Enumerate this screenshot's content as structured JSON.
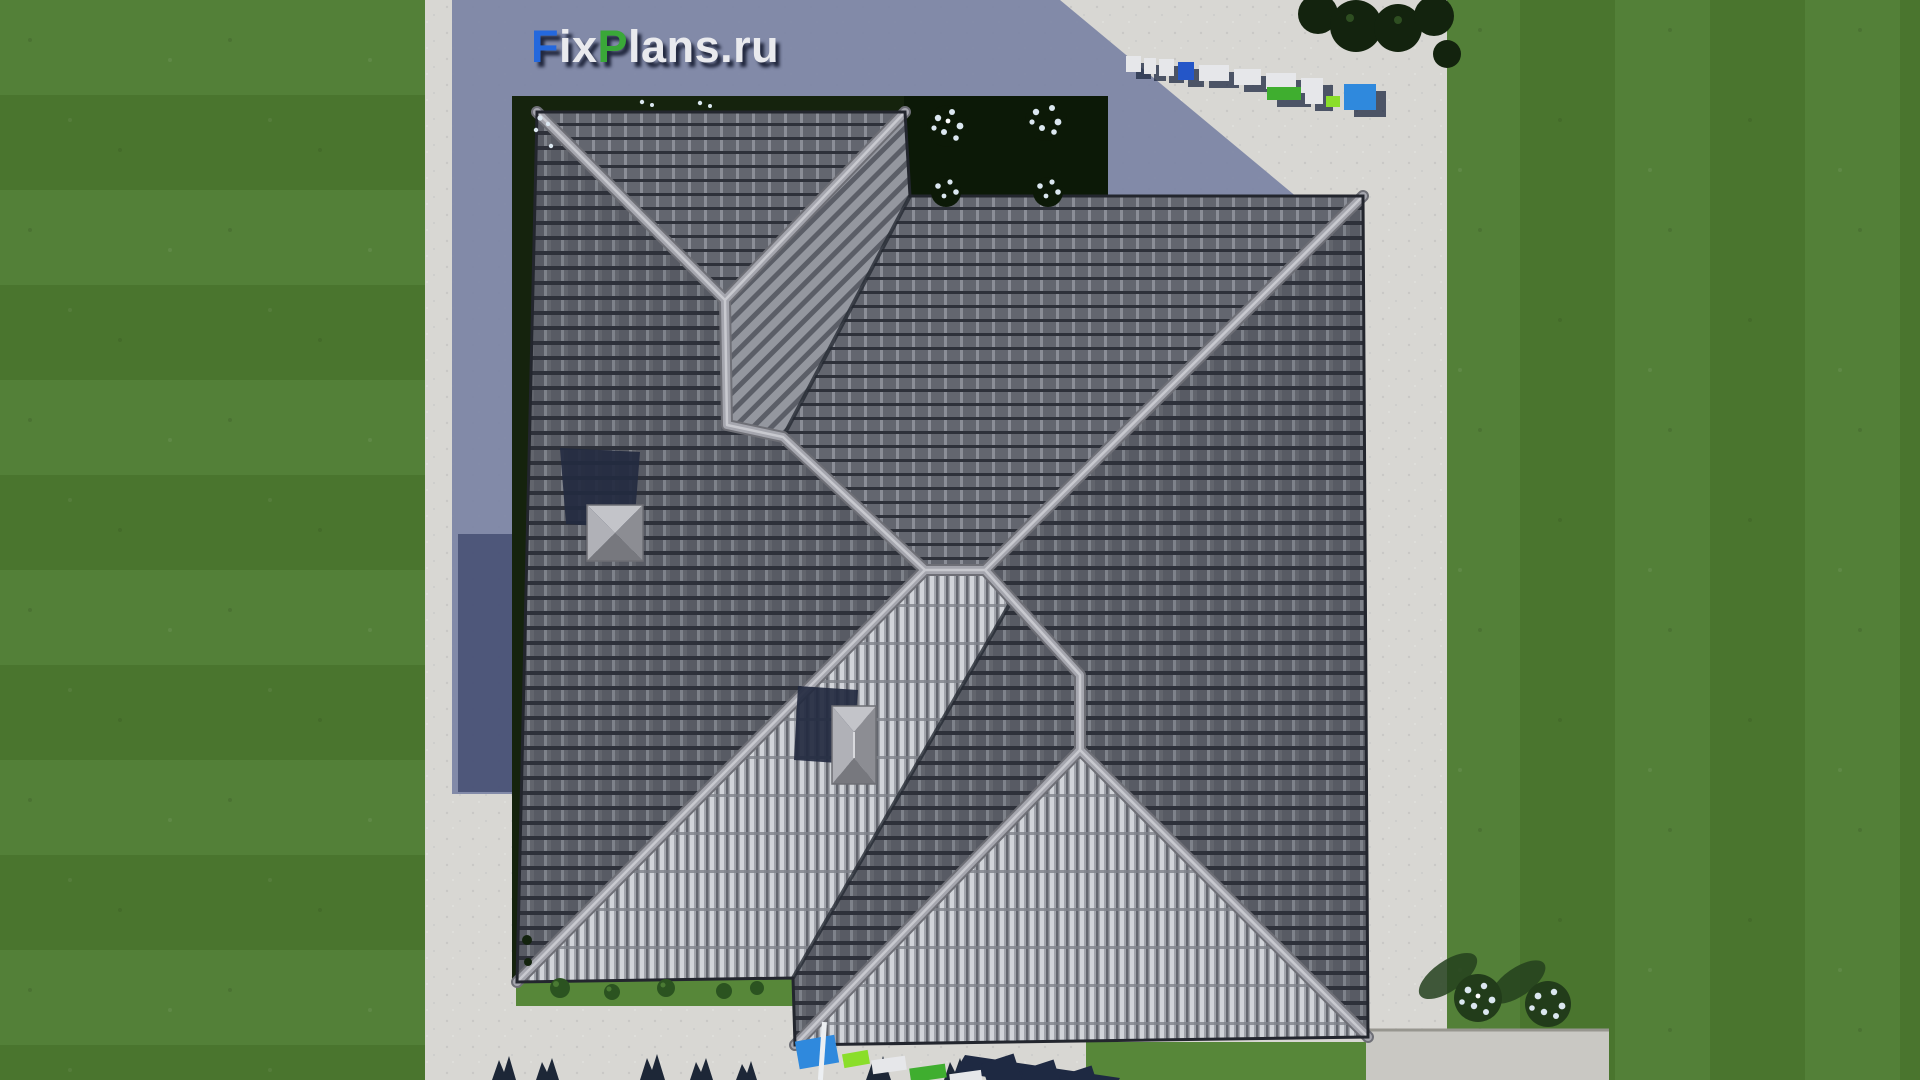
{
  "watermark": {
    "logo_text": "FixPlans.ru",
    "logo_segments": [
      {
        "text": "F",
        "color": "#2468dd"
      },
      {
        "text": "ix",
        "color": "#e9eaee"
      },
      {
        "text": "P",
        "color": "#3aa838"
      },
      {
        "text": "lans",
        "color": "#e9eaee"
      },
      {
        "text": ".ru",
        "color": "#e9eaee"
      }
    ]
  },
  "palette": {
    "lawn": "#4a752e",
    "lawn_light": "#538038",
    "concrete": "#d8d7d3",
    "concrete_shade": "#c9c8c3",
    "shadow_blue": "#7d86a5",
    "shadow_deep": "#454e72",
    "bed": "#15230d",
    "bed_dark": "#0c1907",
    "grass_strip": "#578739",
    "roof_w": "#585b64",
    "roof_n": "#63666f",
    "roof_line": "#2e313a",
    "roof_rib": "#8b8e97",
    "roof_s": "#a1a4ab",
    "roof_s_hi": "#d1d4d9",
    "roof_s_lo": "#63666e",
    "roof_s_line": "#7e828a",
    "band": "#94979f",
    "band_stripe": "#5b5e67",
    "ridge": "#a5a6ae",
    "ridge_hi": "#c8c9cf",
    "ridge_edge": "#6e6f76",
    "valley": "#262a33",
    "eave": "#23262e",
    "cap_top": "#c3c4c9",
    "cap_left": "#b0b1b7",
    "cap_right": "#8c8d93",
    "cap_bottom": "#77787e",
    "chimney_shadow": "#232a40",
    "logo_shadow": "rgba(16,22,44,0.85)",
    "wm_white": "#e6e7ea",
    "wm_blue": "#2f89dd",
    "wm_blue_deep": "#2456c8",
    "wm_green": "#3fae2f",
    "wm_green_light": "#8ade2a",
    "wm_navy": "#1e2942",
    "flower": "#dbe7f0",
    "bush": "#223c1a",
    "bush_shadow": "#24411d",
    "shrub": "#2b5320",
    "shrub_hi": "#4a7a33",
    "tree_navy": "#1d2737",
    "hedge": "#13230e"
  }
}
